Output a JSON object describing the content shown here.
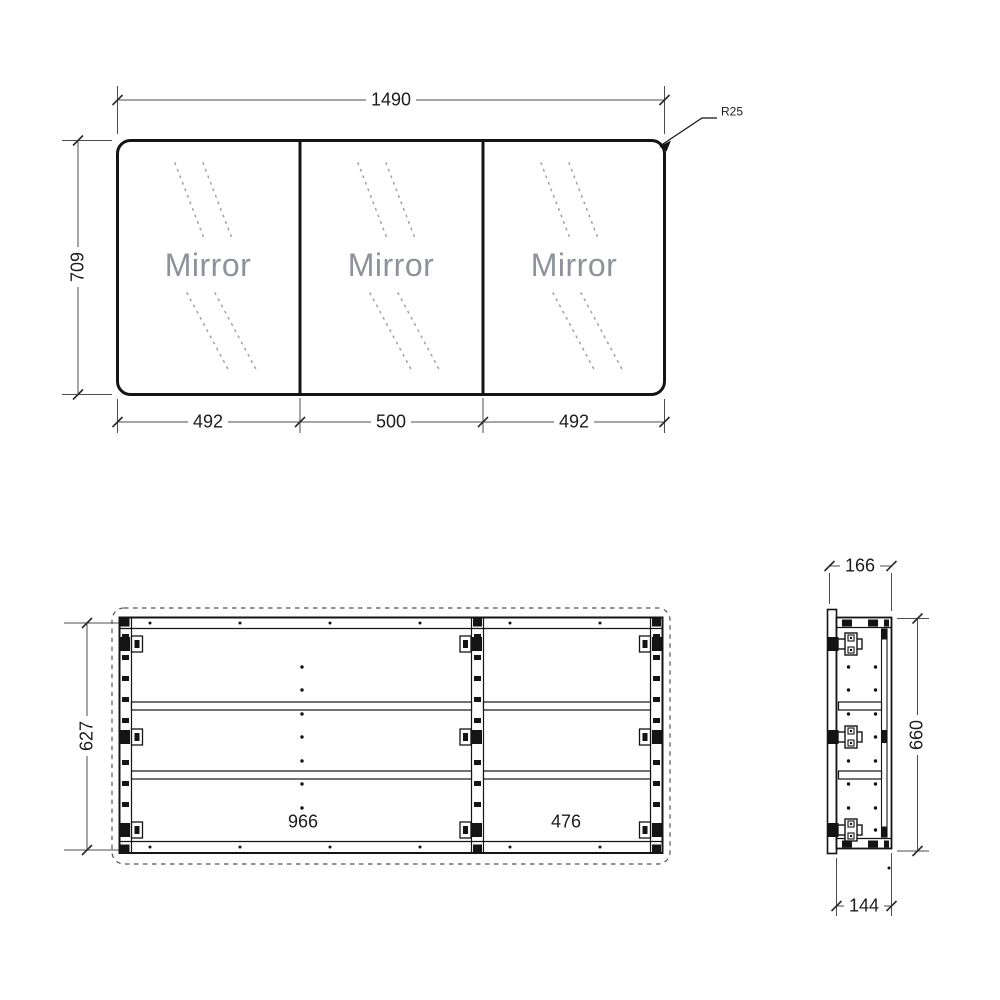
{
  "front_view": {
    "overall_width": "1490",
    "overall_height": "709",
    "corner_radius": "R25",
    "door_widths": [
      "492",
      "500",
      "492"
    ],
    "panels": [
      {
        "label": "Mirror"
      },
      {
        "label": "Mirror"
      },
      {
        "label": "Mirror"
      }
    ]
  },
  "internal_view": {
    "overall_height": "627",
    "left_bay_width": "966",
    "right_bay_width": "476"
  },
  "side_view": {
    "overall_depth": "166",
    "overall_height": "660",
    "cabinet_depth": "144"
  },
  "colors": {
    "object_line": "#141414",
    "dimension_line": "#4d4d4d",
    "dimension_text": "#1c1c1e",
    "mirror_text": "#8d929b",
    "glint_line": "#9ba1a9"
  }
}
